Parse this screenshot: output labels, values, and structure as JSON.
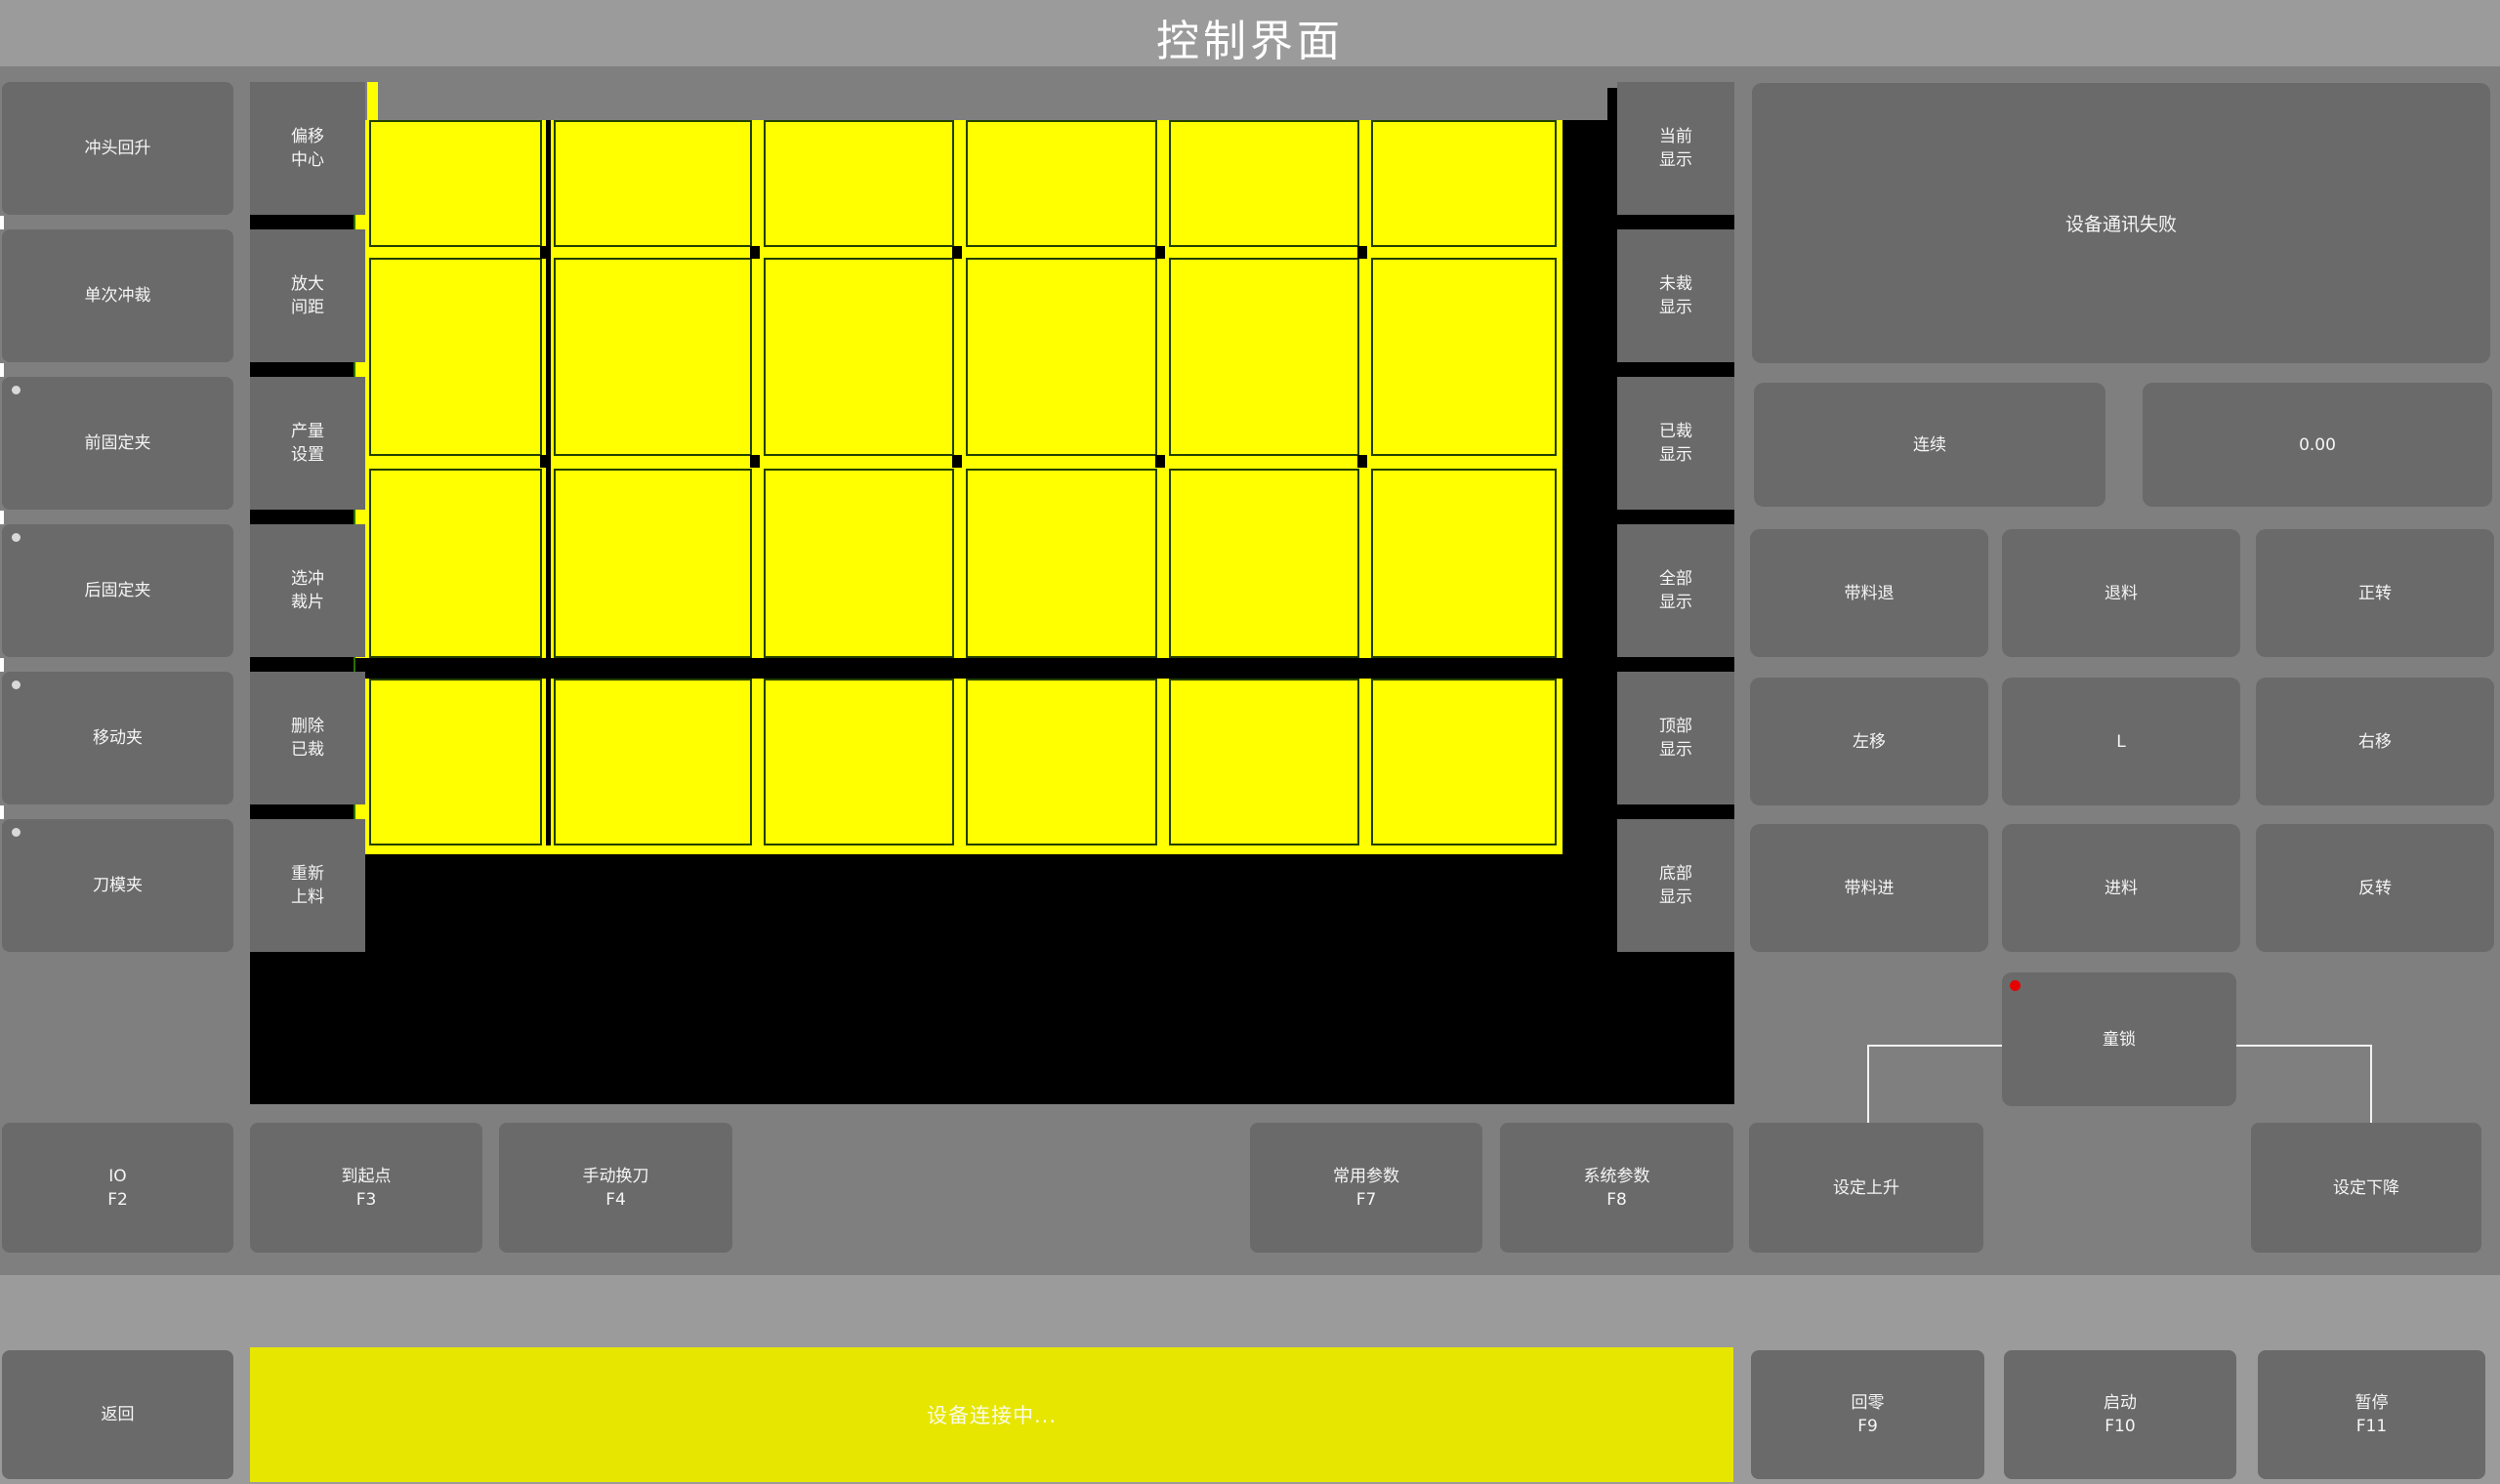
{
  "title": "控制界面",
  "left_column": {
    "buttons": [
      {
        "label": "冲头回升",
        "indicator": false
      },
      {
        "label": "单次冲裁",
        "indicator": false
      },
      {
        "label": "前固定夹",
        "indicator": true
      },
      {
        "label": "后固定夹",
        "indicator": true
      },
      {
        "label": "移动夹",
        "indicator": true
      },
      {
        "label": "刀模夹",
        "indicator": true
      }
    ]
  },
  "tool_column": {
    "buttons": [
      {
        "label": "偏移\n中心"
      },
      {
        "label": "放大\n间距"
      },
      {
        "label": "产量\n设置"
      },
      {
        "label": "选冲\n裁片"
      },
      {
        "label": "删除\n已裁"
      },
      {
        "label": "重新\n上料"
      }
    ]
  },
  "display_column": {
    "buttons": [
      {
        "label": "当前\n显示"
      },
      {
        "label": "未裁\n显示"
      },
      {
        "label": "已裁\n显示"
      },
      {
        "label": "全部\n显示"
      },
      {
        "label": "顶部\n显示"
      },
      {
        "label": "底部\n显示"
      }
    ]
  },
  "canvas": {
    "background": "#000000",
    "piece_grid": {
      "columns": 6,
      "rows": 4,
      "cell_color": "#ffff00",
      "line_color": "#234000",
      "tick_color": "#000000"
    }
  },
  "right_panel": {
    "status_message": "设备通讯失败",
    "mode_button": "连续",
    "value_display": "0.00",
    "jog_grid": [
      [
        "带料退",
        "退料",
        "正转"
      ],
      [
        "左移",
        "L",
        "右移"
      ],
      [
        "带料进",
        "进料",
        "反转"
      ]
    ],
    "child_lock": "童锁"
  },
  "function_row": {
    "buttons": [
      {
        "label": "IO",
        "fkey": "F2"
      },
      {
        "label": "到起点",
        "fkey": "F3"
      },
      {
        "label": "手动换刀",
        "fkey": "F4"
      },
      {
        "label": "常用参数",
        "fkey": "F7"
      },
      {
        "label": "系统参数",
        "fkey": "F8"
      },
      {
        "label": "设定上升",
        "fkey": ""
      },
      {
        "label": "设定下降",
        "fkey": ""
      }
    ]
  },
  "bottom_bar": {
    "back_label": "返回",
    "status_text": "设备连接中...",
    "buttons": [
      {
        "label": "回零",
        "fkey": "F9"
      },
      {
        "label": "启动",
        "fkey": "F10"
      },
      {
        "label": "暂停",
        "fkey": "F11"
      }
    ]
  }
}
